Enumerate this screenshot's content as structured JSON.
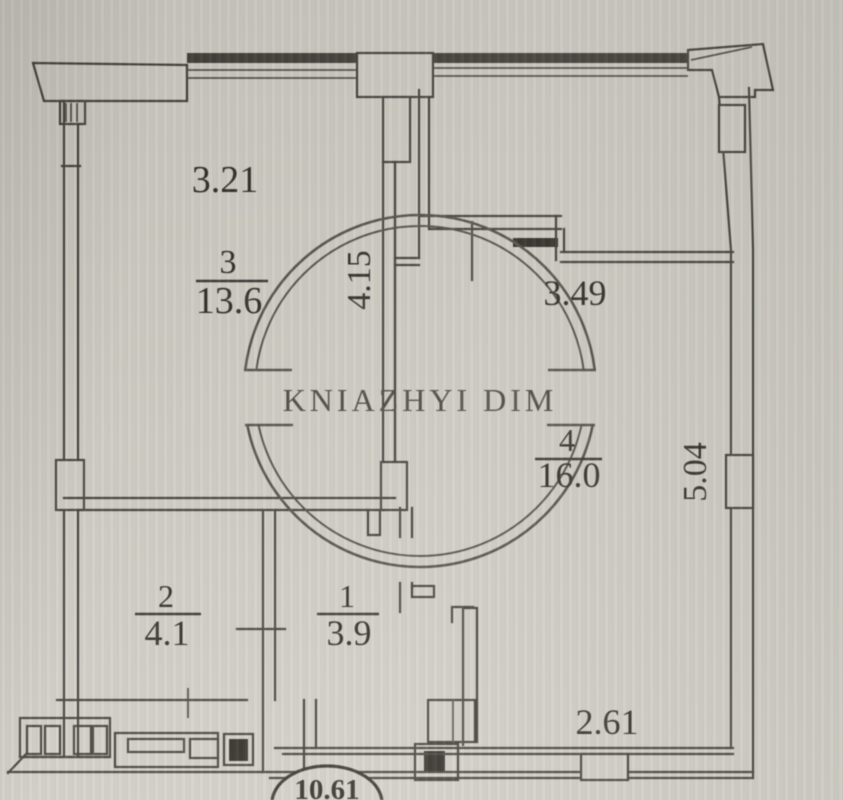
{
  "watermark": {
    "text": "KNIAZHYI DIM"
  },
  "rooms": [
    {
      "number": "3",
      "area": "13.6"
    },
    {
      "number": "2",
      "area": "4.1"
    },
    {
      "number": "1",
      "area": "3.9"
    },
    {
      "number": "4",
      "area": "16.0"
    }
  ],
  "dimensions": {
    "top_width": "3.21",
    "left_depth": "4.15",
    "upper_right_width": "3.49",
    "right_depth": "5.04",
    "bottom_width": "2.61"
  },
  "stamp": {
    "value": "10.61"
  }
}
